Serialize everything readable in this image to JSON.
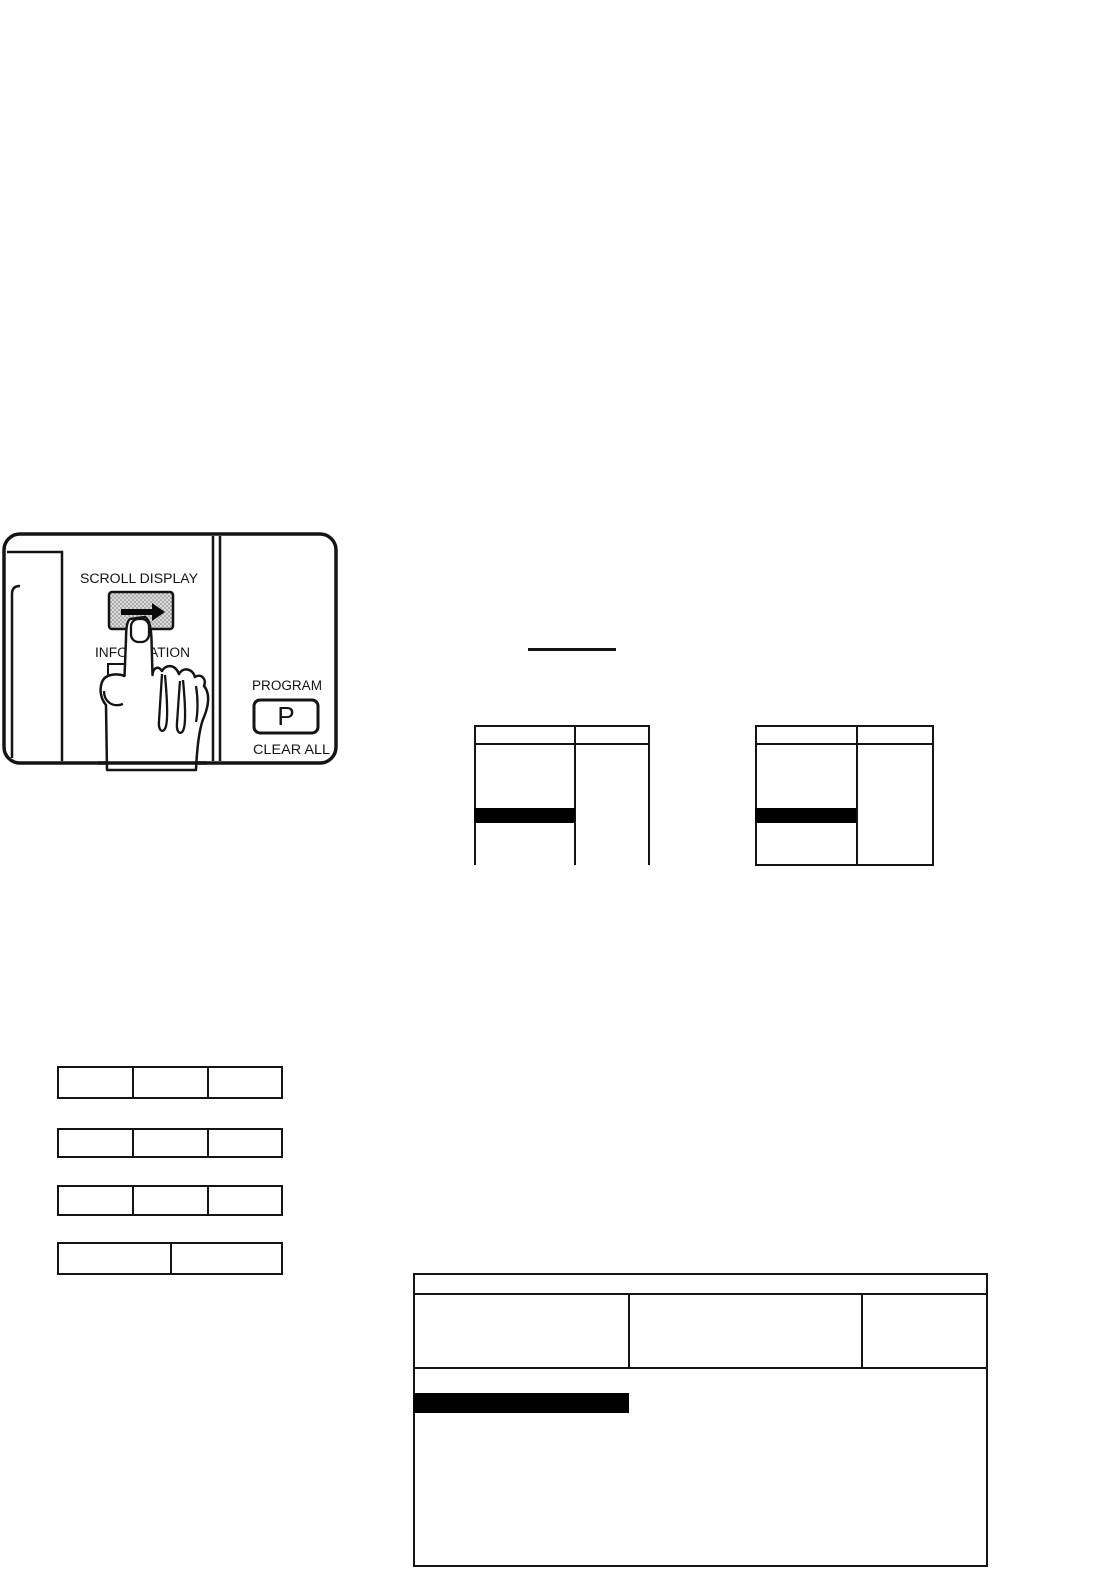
{
  "document": {
    "type": "scanned manual page",
    "background": "#ffffff",
    "ink_color": "#141414"
  },
  "control_panel_figure": {
    "labels": {
      "scroll_display": "SCROLL DISPLAY",
      "information": "INFORMATION",
      "program": "PROGRAM",
      "program_key": "P",
      "clear_all": "CLEAR ALL"
    },
    "icons": {
      "scroll_button": "right-arrow-icon",
      "pressing_hand": "pointing-hand-icon"
    },
    "colors": {
      "button_halftone_fill": "#d9d9d9",
      "button_halftone_dot": "#909090",
      "arrow": "#0a0a0a",
      "highlight_bar": "#000000"
    }
  },
  "inline_rule": {
    "present": true
  },
  "display_tables": {
    "left": {
      "columns": 2,
      "header_row_empty": true,
      "cells_empty": true,
      "highlight_bar_in_col1": true,
      "bottom_border": false
    },
    "right": {
      "columns": 2,
      "header_row_empty": true,
      "cells_empty": true,
      "highlight_bar_in_col1": true,
      "bottom_border": true
    }
  },
  "option_rows": [
    {
      "cells": 3,
      "cells_empty": true
    },
    {
      "cells": 3,
      "cells_empty": true
    },
    {
      "cells": 3,
      "cells_empty": true
    },
    {
      "cells": 2,
      "cells_empty": true
    }
  ],
  "bottom_table": {
    "header_band_empty": true,
    "columns": 3,
    "cells_empty": true,
    "highlight_bar_in_col1": true
  }
}
